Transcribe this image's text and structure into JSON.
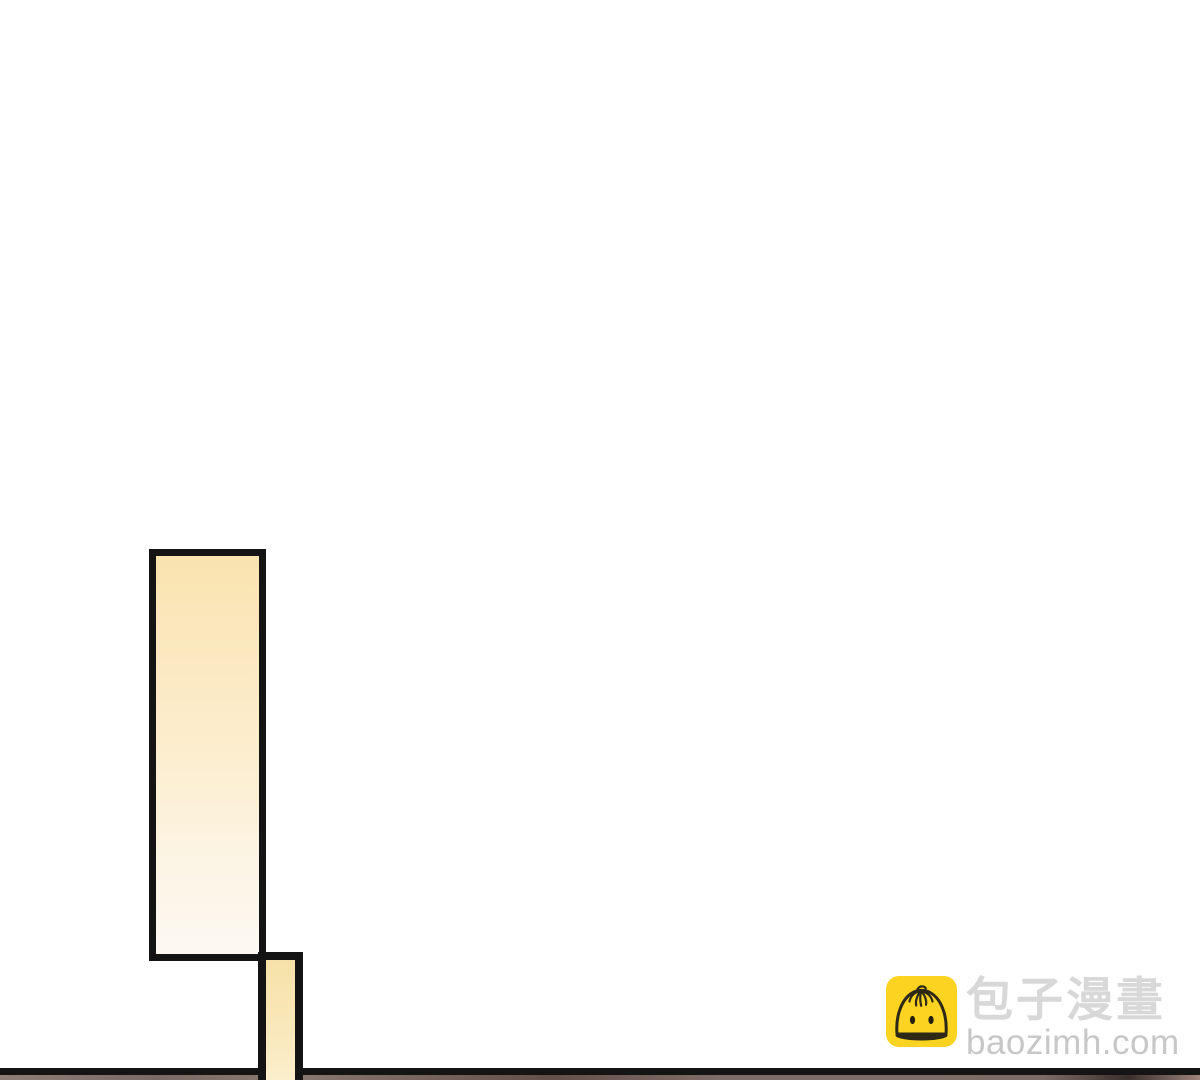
{
  "page": {
    "type": "comic-reader-page",
    "background_color": "#ffffff"
  },
  "panels": {
    "border_color": "#141414",
    "tall_panel_fill_top": "#f9e3af",
    "tall_panel_fill_bottom": "#fdf9f2",
    "strip_panel_fill_top": "#f6e1a8",
    "strip_panel_fill_bottom": "#fbeecb",
    "next_panel_edge_color": "#7e6d66"
  },
  "watermark": {
    "brand_zh": "包子漫畫",
    "brand_url": "baozimh.com",
    "icon": "baozi-bun-icon",
    "icon_bg_color": "#fbd320",
    "icon_line_color": "#2e2916",
    "brand_text_color": "#d8d8d8",
    "url_text_color": "#c7c7c7"
  }
}
